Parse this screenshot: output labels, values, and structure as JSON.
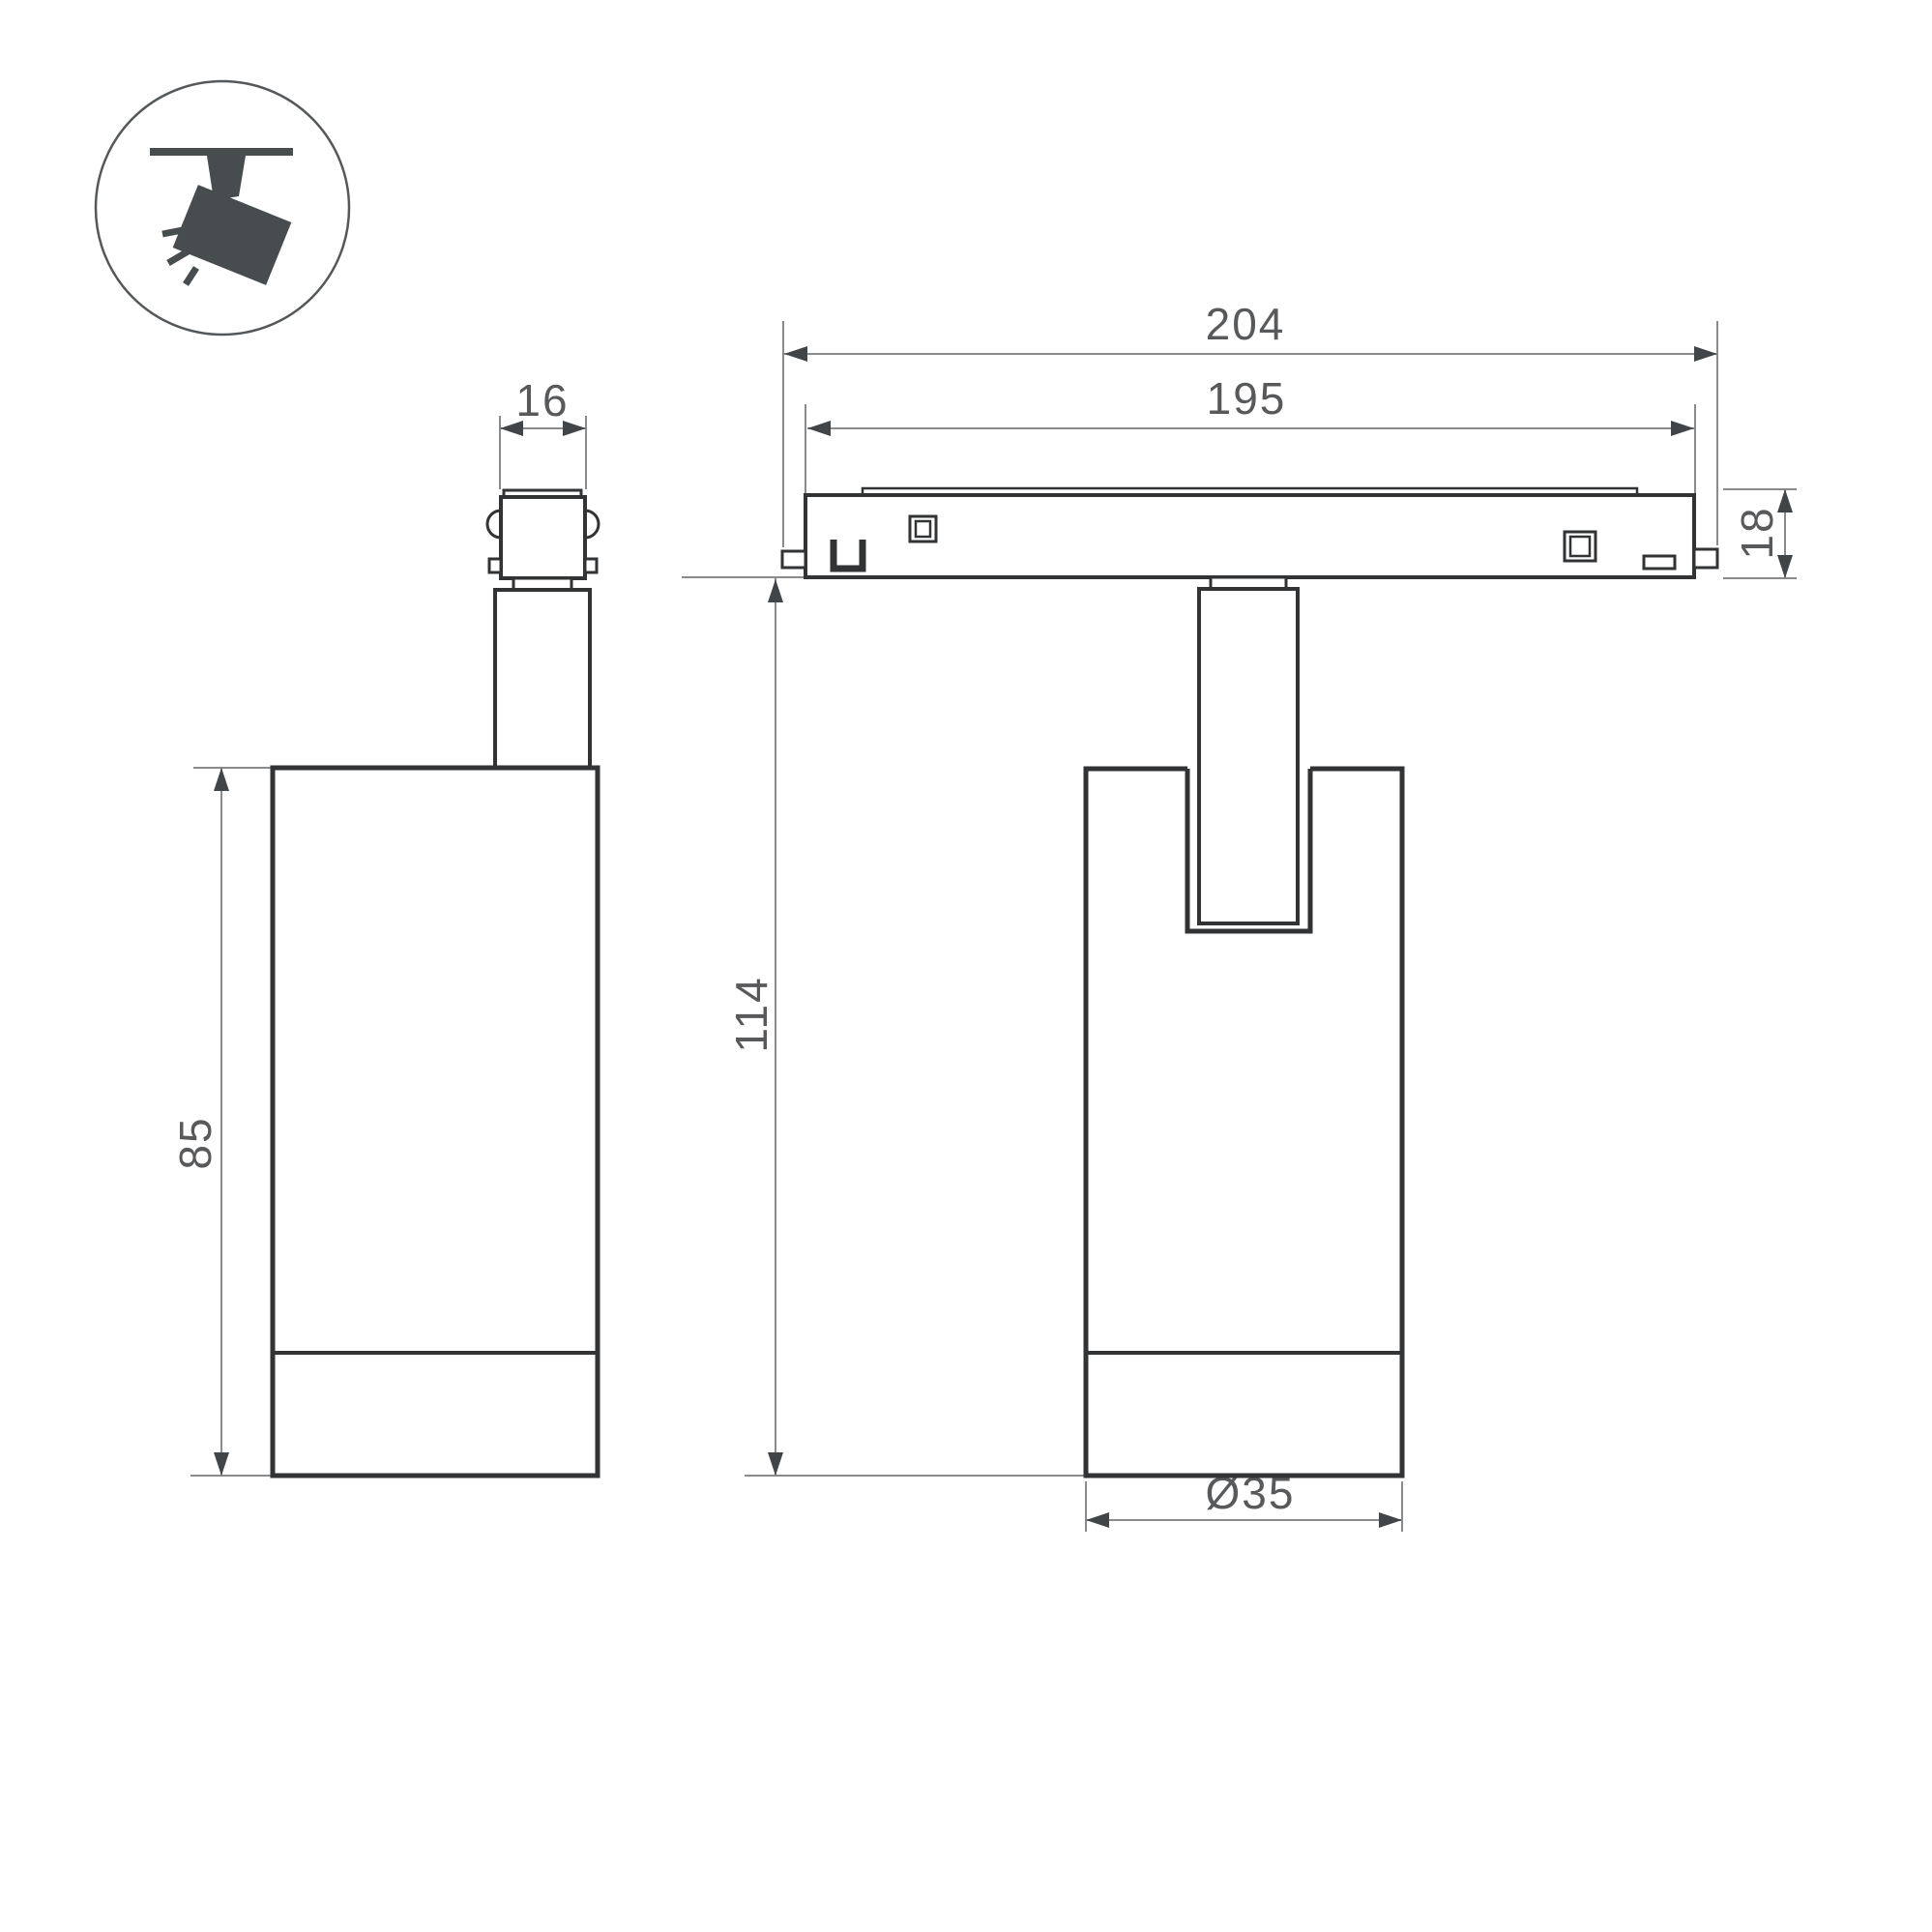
{
  "drawing": {
    "title": "track-spotlight-dimension-drawing",
    "icon": {
      "name": "ceiling-track-spotlight-pictogram"
    },
    "dimensions": {
      "adapter_width": "16",
      "body_height_side": "85",
      "track_length_outer": "204",
      "track_length_inner": "195",
      "track_height": "18",
      "fixture_height": "114",
      "body_diameter": "Ø35"
    },
    "colors": {
      "background": "#ffffff",
      "outline": "#313335",
      "dimension_line": "#8a8b8d",
      "dimension_text": "#58595b",
      "icon_fill": "#474c4f"
    }
  }
}
